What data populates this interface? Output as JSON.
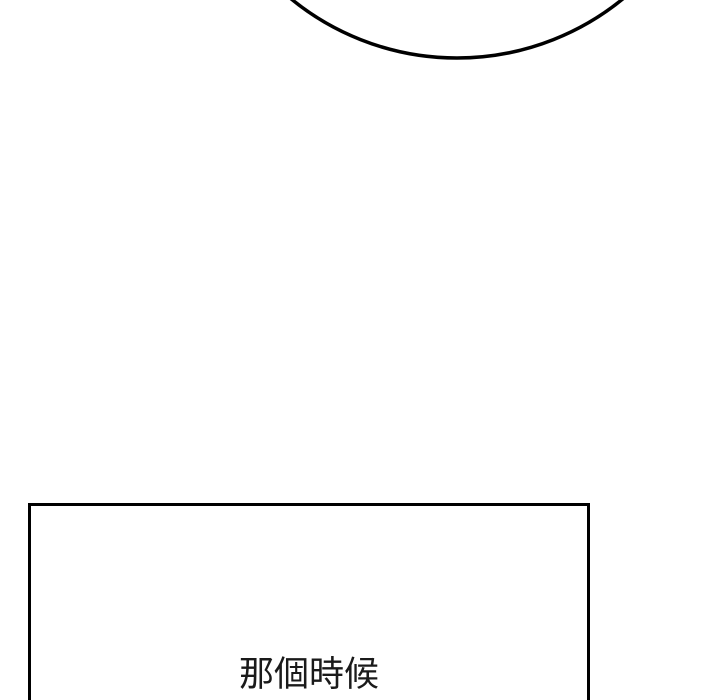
{
  "page": {
    "background_color": "#ffffff",
    "line_color": "#000000"
  },
  "speech_bubble": {
    "stroke_color": "#000000"
  },
  "panel": {
    "border_color": "#000000",
    "dialogue_text": "那個時候",
    "text_color": "#1a1a1a"
  }
}
